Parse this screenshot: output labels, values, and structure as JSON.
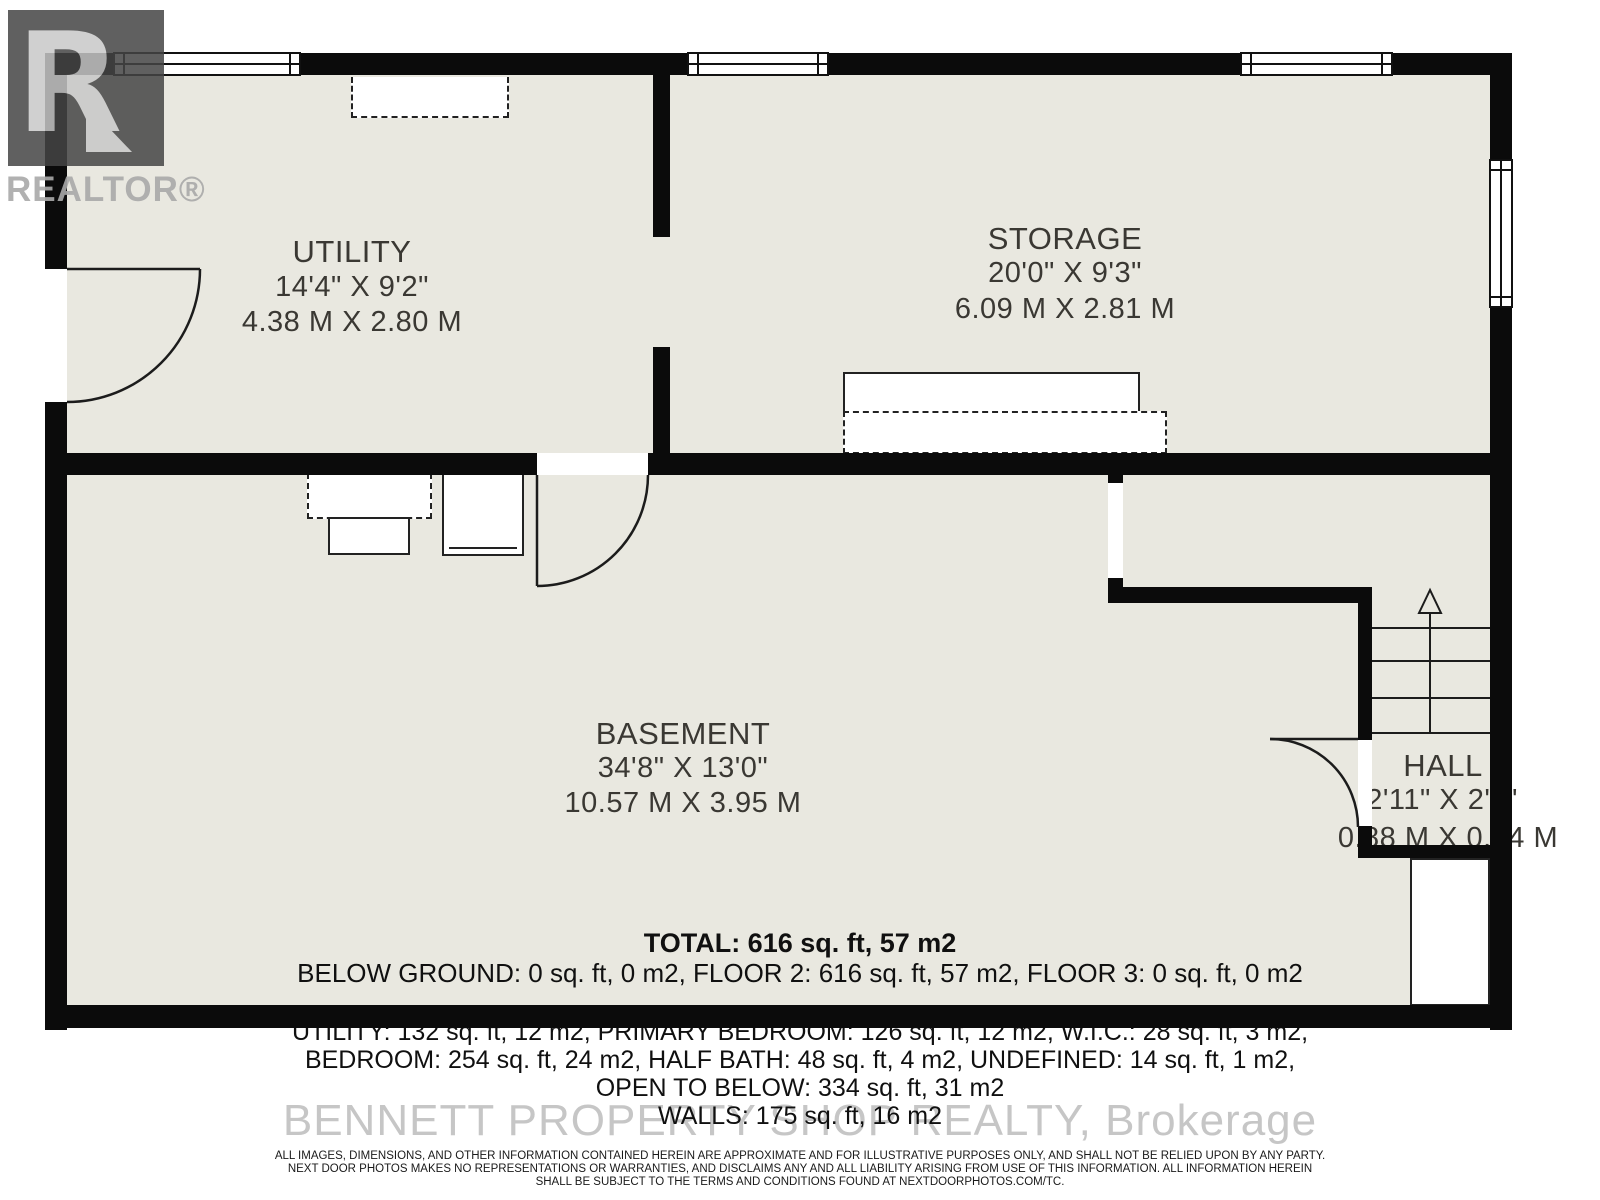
{
  "branding": {
    "logo_letter": "R",
    "logo_label": "REALTOR®",
    "watermark": "BENNETT PROPERTY SHOP REALTY, Brokerage"
  },
  "rooms": {
    "utility": {
      "name": "UTILITY",
      "dim_ft": "14'4\" X 9'2\"",
      "dim_m": "4.38 M X 2.80 M"
    },
    "storage": {
      "name": "STORAGE",
      "dim_ft": "20'0\" X 9'3\"",
      "dim_m": "6.09 M X 2.81 M"
    },
    "basement": {
      "name": "BASEMENT",
      "dim_ft": "34'8\" X 13'0\"",
      "dim_m": "10.57 M X 3.95 M"
    },
    "hall": {
      "name": "HALL",
      "dim_ft": "2'11\" X 2'9\"",
      "dim_m": "0.88 M X 0.84 M"
    }
  },
  "summary": {
    "total": "TOTAL: 616 sq. ft, 57 m2",
    "floors": "BELOW GROUND: 0 sq. ft, 0 m2, FLOOR 2: 616 sq. ft, 57 m2, FLOOR 3: 0 sq. ft, 0 m2",
    "line1": "UTILITY: 132 sq. ft, 12 m2, PRIMARY BEDROOM: 126 sq. ft, 12 m2, W.I.C.: 28 sq. ft, 3 m2,",
    "line2": "BEDROOM: 254 sq. ft, 24 m2, HALF BATH: 48 sq. ft, 4 m2, UNDEFINED: 14 sq. ft, 1 m2,",
    "line3": "OPEN TO BELOW: 334 sq. ft, 31 m2",
    "line4": "WALLS: 175 sq. ft, 16 m2"
  },
  "disclaimer": {
    "line1": "ALL IMAGES, DIMENSIONS, AND OTHER INFORMATION CONTAINED HEREIN ARE APPROXIMATE AND FOR ILLUSTRATIVE PURPOSES ONLY, AND SHALL NOT BE RELIED UPON BY ANY PARTY.",
    "line2": "NEXT DOOR PHOTOS MAKES NO REPRESENTATIONS OR WARRANTIES, AND DISCLAIMS ANY AND ALL LIABILITY ARISING FROM USE OF THIS INFORMATION. ALL INFORMATION HEREIN",
    "line3": "SHALL BE SUBJECT TO THE TERMS AND CONDITIONS FOUND AT NEXTDOORPHOTOS.COM/TC."
  },
  "colors": {
    "floor": "#e9e8e0",
    "wall": "#0b0b0b",
    "label": "#3a3833",
    "watermark": "#c6c6c6"
  }
}
